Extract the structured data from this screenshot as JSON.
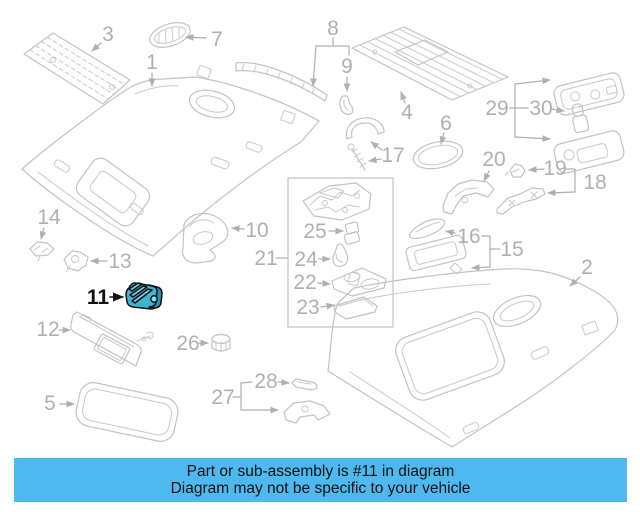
{
  "banner": {
    "line1": "Part or sub-assembly is #11 in diagram",
    "line2": "Diagram may not be specific to your vehicle",
    "bg_color": "#4db9ef",
    "text_color": "#111111"
  },
  "diagram": {
    "highlighted_part_number": "11",
    "highlight_color": "#3fb6cf",
    "highlight_color_dark": "#2395ad",
    "highlight_color_light": "#6fd0e2",
    "line_color": "#c3c3c3",
    "label_color": "#b0b0b0",
    "callout_labels": [
      "1",
      "2",
      "3",
      "4",
      "5",
      "6",
      "7",
      "8",
      "9",
      "10",
      "11",
      "12",
      "13",
      "14",
      "15",
      "16",
      "17",
      "18",
      "19",
      "20",
      "21",
      "22",
      "23",
      "24",
      "25",
      "26",
      "27",
      "28",
      "29",
      "30"
    ]
  }
}
